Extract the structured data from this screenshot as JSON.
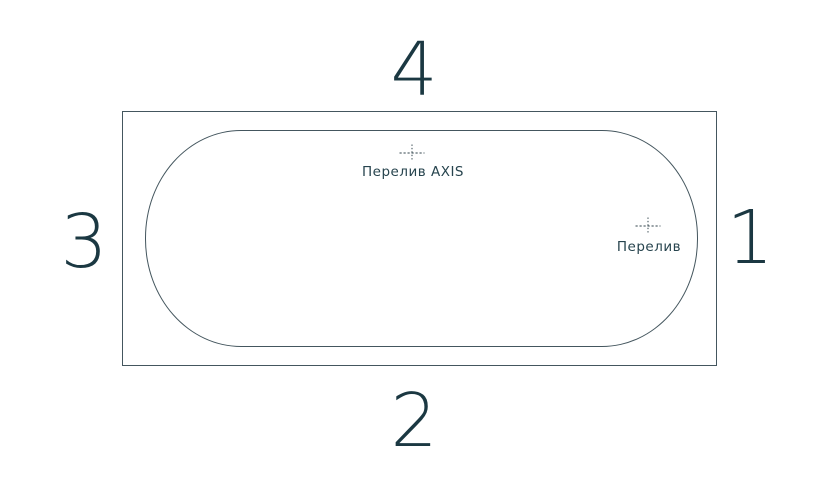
{
  "colors": {
    "background": "#ffffff",
    "line": "#44565e",
    "marker": "#33464e",
    "label_text": "#27444e",
    "digit_text": "#1b3842"
  },
  "diagram": {
    "type": "bathtub-top-view-scheme",
    "side_labels": {
      "top": "4",
      "bottom": "2",
      "left": "3",
      "right": "1"
    },
    "markers": {
      "overflow_axis": {
        "label": "Перелив AXIS",
        "icon": "center-mark-crosshair"
      },
      "overflow": {
        "label": "Перелив",
        "icon": "center-mark-crosshair"
      }
    }
  }
}
